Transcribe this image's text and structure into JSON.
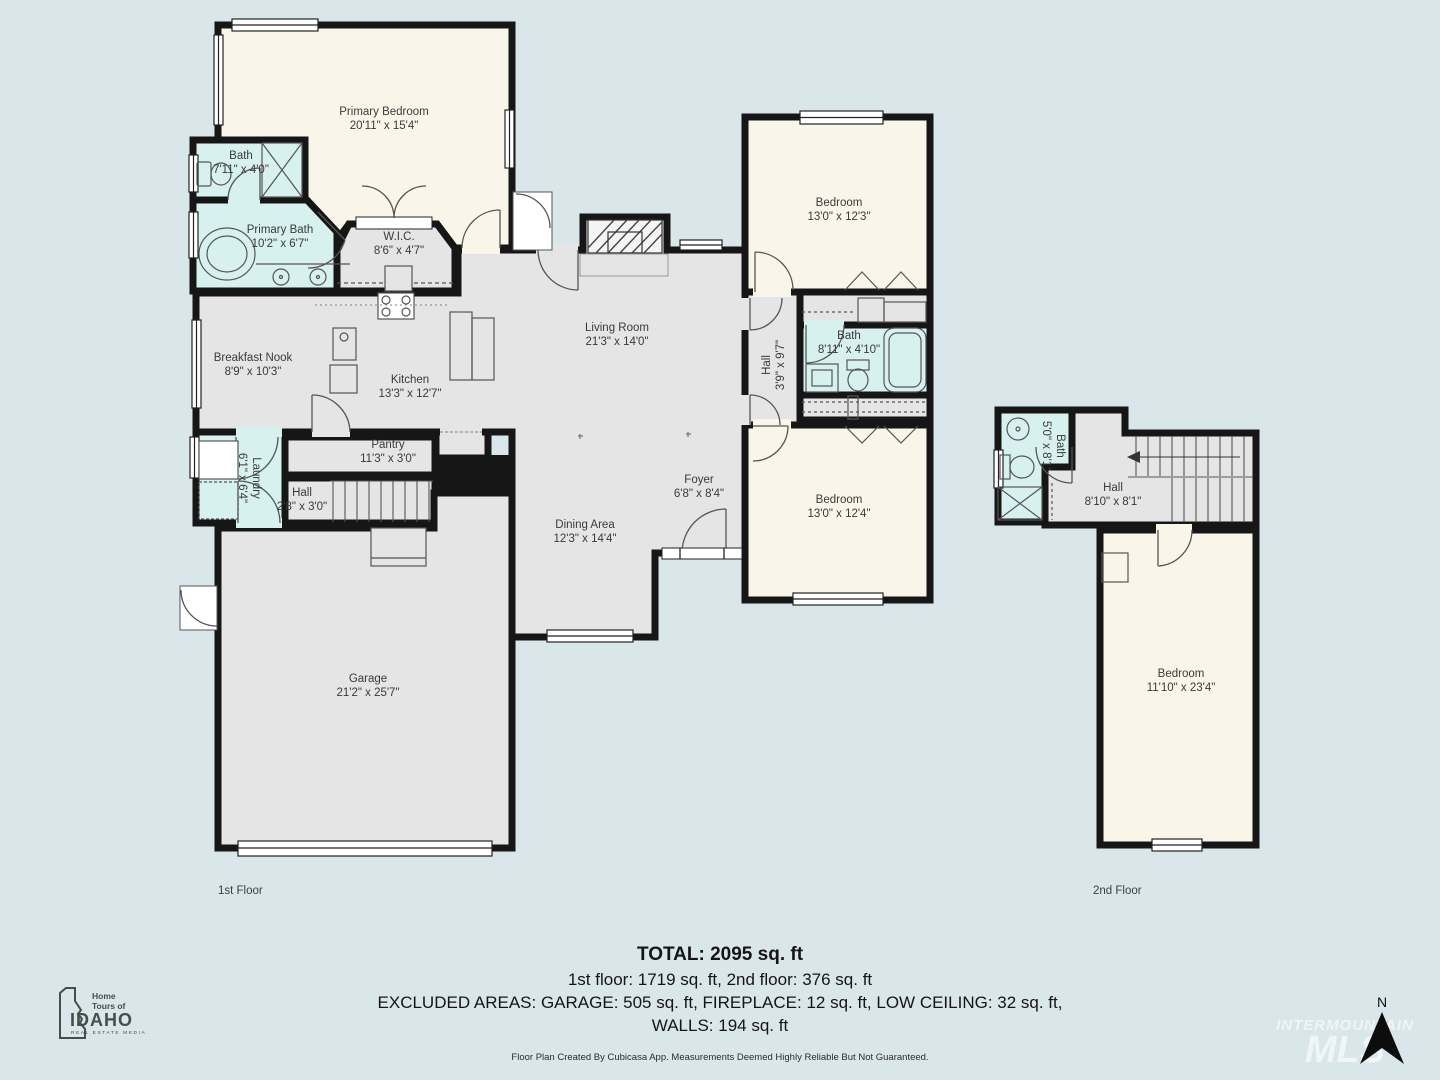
{
  "palette": {
    "background": "#d9e6ea",
    "wall": "#161616",
    "room_gray": "#e5e5e6",
    "room_cream": "#faf5e9",
    "room_cyan": "#d7f1ee",
    "label_text": "#3a3a3a"
  },
  "floor1": {
    "caption": "1st Floor",
    "rooms": [
      {
        "name": "Primary Bedroom",
        "dims": "20'11\" x 15'4\""
      },
      {
        "name": "Bath",
        "dims": "7'11\" x 4'0\""
      },
      {
        "name": "Primary Bath",
        "dims": "10'2\" x 6'7\""
      },
      {
        "name": "W.I.C.",
        "dims": "8'6\" x 4'7\""
      },
      {
        "name": "Living Room",
        "dims": "21'3\" x 14'0\""
      },
      {
        "name": "Breakfast Nook",
        "dims": "8'9\" x 10'3\""
      },
      {
        "name": "Kitchen",
        "dims": "13'3\" x 12'7\""
      },
      {
        "name": "Pantry",
        "dims": "11'3\" x 3'0\""
      },
      {
        "name": "Laundry",
        "dims": "6'1\" x 6'4\""
      },
      {
        "name": "Hall",
        "dims": "2'8\" x 3'0\""
      },
      {
        "name": "Dining Area",
        "dims": "12'3\" x 14'4\""
      },
      {
        "name": "Foyer",
        "dims": "6'8\" x 8'4\""
      },
      {
        "name": "Hall",
        "dims": "3'9\" x 9'7\""
      },
      {
        "name": "Bedroom",
        "dims": "13'0\" x 12'3\""
      },
      {
        "name": "Bath",
        "dims": "8'11\" x 4'10\""
      },
      {
        "name": "Bedroom",
        "dims": "13'0\" x 12'4\""
      },
      {
        "name": "Garage",
        "dims": "21'2\" x 25'7\""
      }
    ]
  },
  "floor2": {
    "caption": "2nd Floor",
    "rooms": [
      {
        "name": "Bath",
        "dims": "5'0\" x 8'1\""
      },
      {
        "name": "Hall",
        "dims": "8'10\" x 8'1\""
      },
      {
        "name": "Bedroom",
        "dims": "11'10\" x 23'4\""
      }
    ]
  },
  "summary": {
    "total": "TOTAL: 2095 sq. ft",
    "floors": "1st floor: 1719 sq. ft, 2nd floor: 376 sq. ft",
    "excluded": "EXCLUDED AREAS: GARAGE: 505 sq. ft, FIREPLACE: 12 sq. ft, LOW CEILING: 32 sq. ft,",
    "walls": "WALLS: 194 sq. ft",
    "disclaimer": "Floor Plan Created By Cubicasa App. Measurements Deemed Highly Reliable But Not Guaranteed."
  },
  "logo": {
    "line1": "Home",
    "line2": "Tours of",
    "name": "IDAHO",
    "tagline": "Real Estate Media"
  },
  "compass": {
    "label": "N"
  },
  "watermark": {
    "line1": "INTERMOUNTAIN",
    "line2": "MLS"
  }
}
